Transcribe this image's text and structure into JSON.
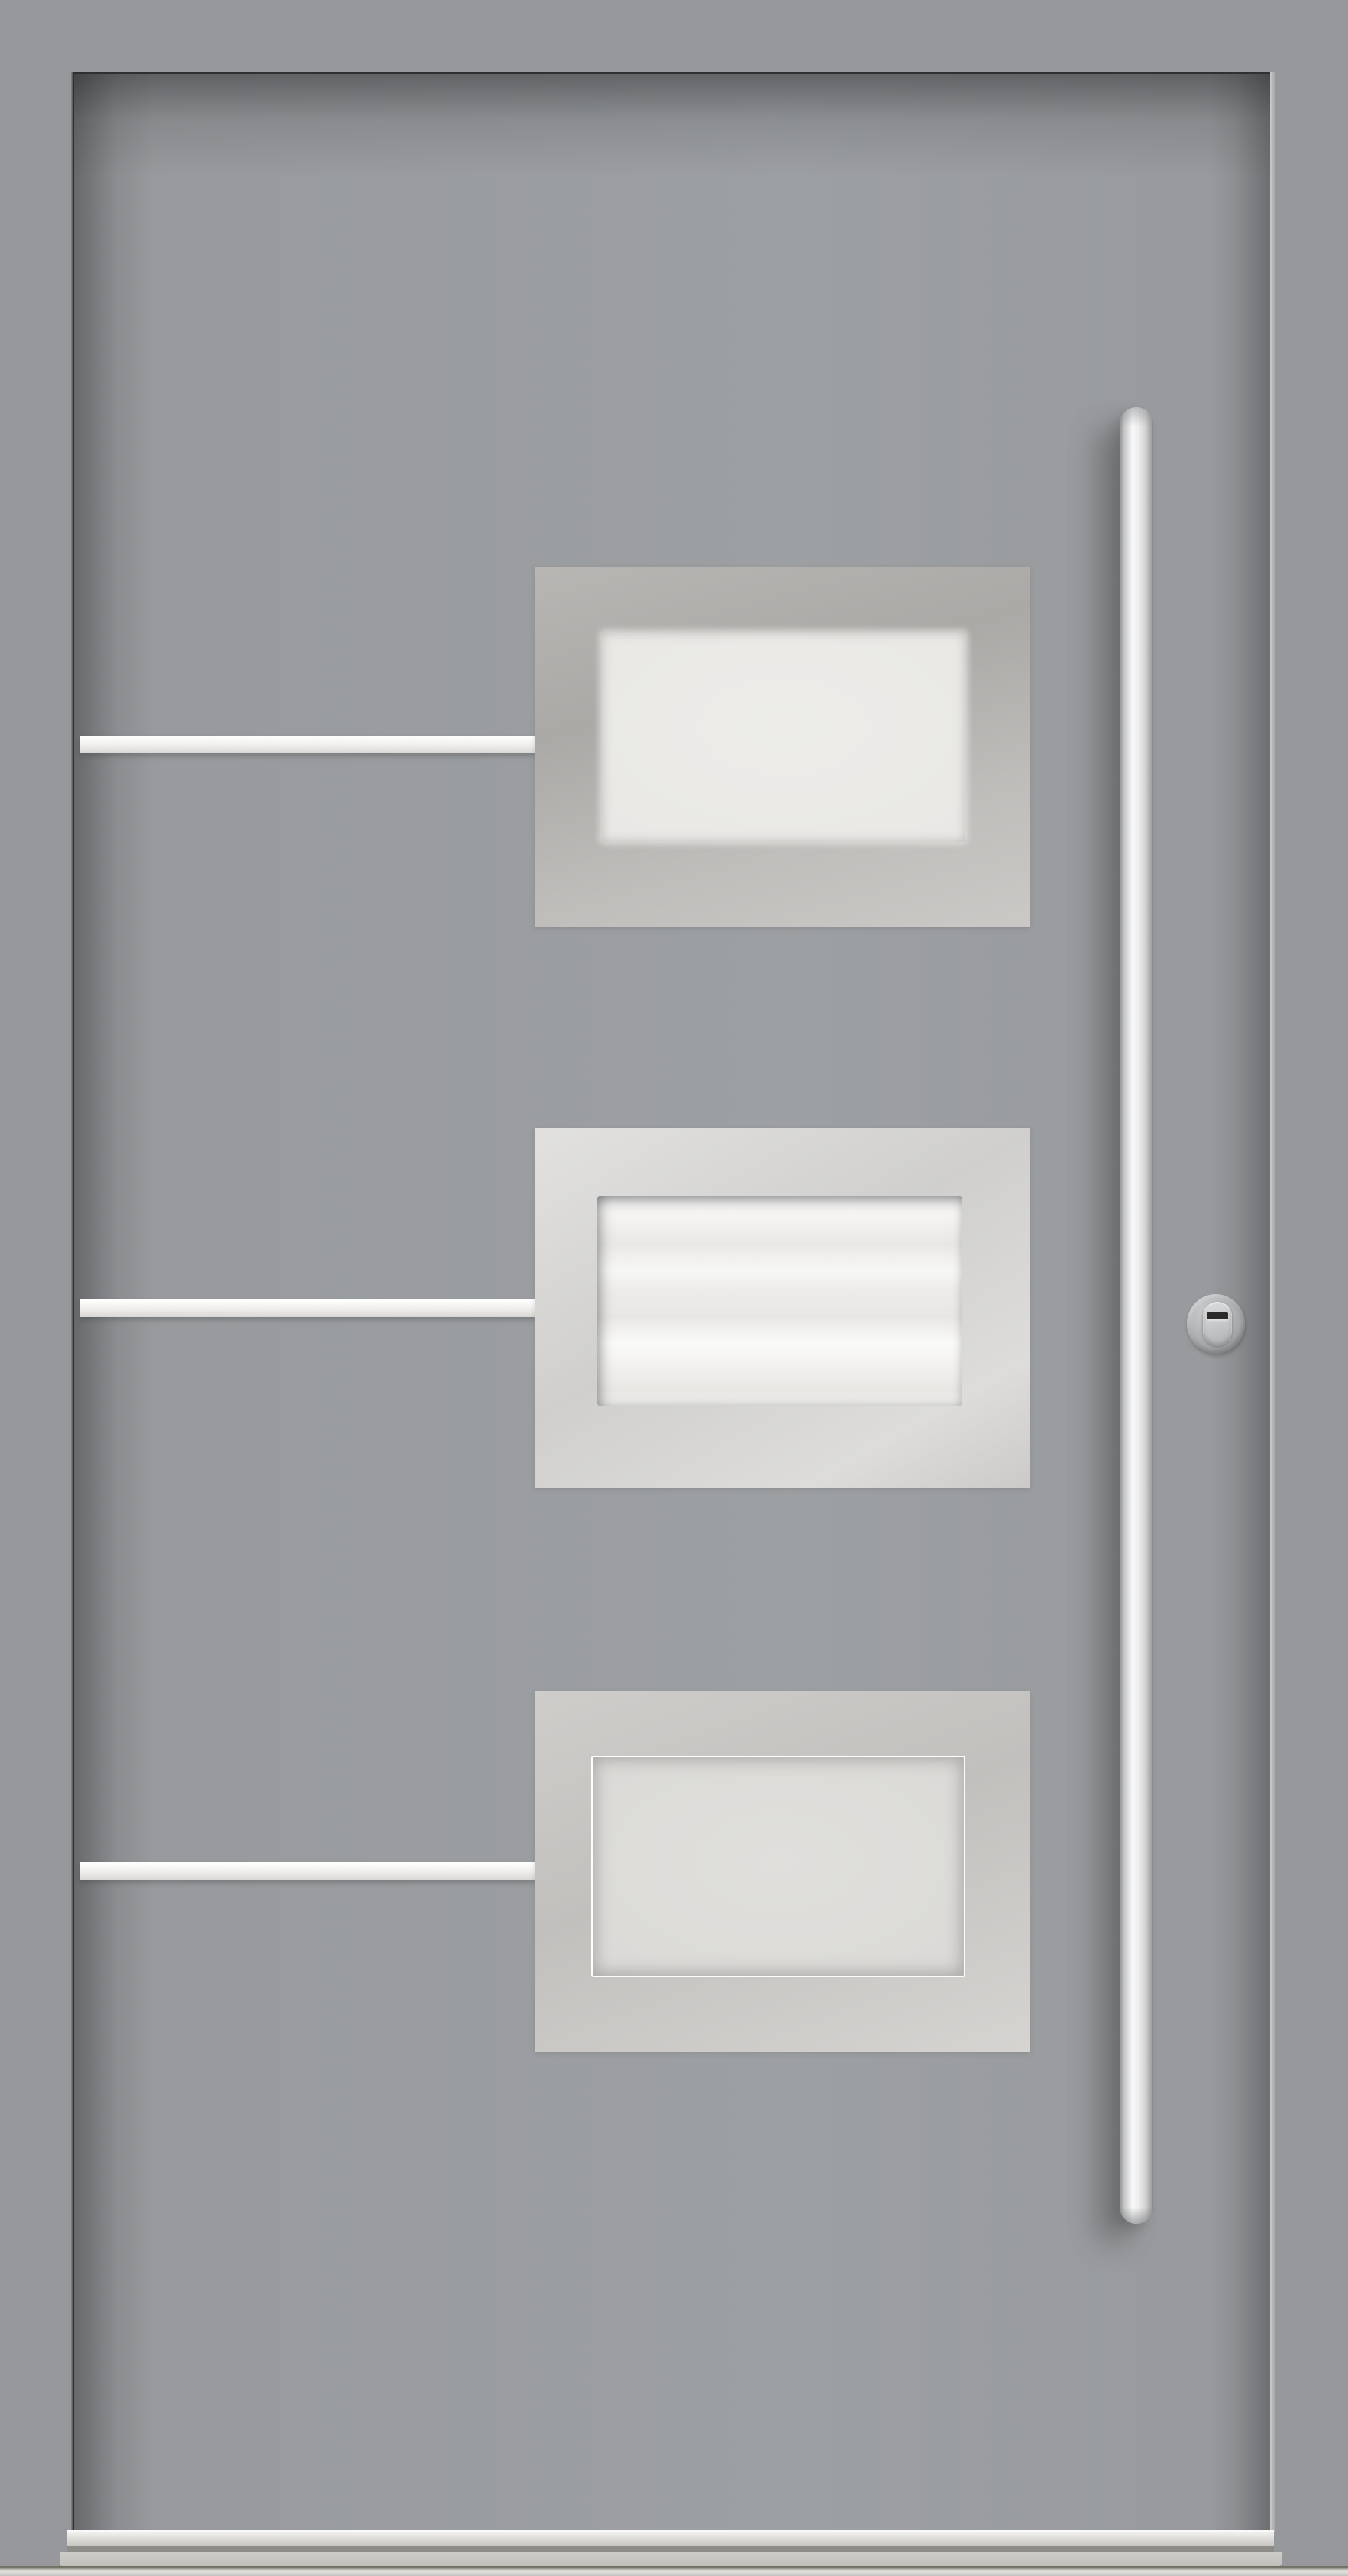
{
  "image": {
    "type": "product-photo",
    "subject": "Modern gray aluminium entrance door, front view",
    "visible_text": "",
    "features": {
      "door_leaf": "flat gray aluminium leaf with shadowed seams on top and left, highlighted seam on right",
      "glazing_panels": {
        "count": 3,
        "description": "rectangular brushed stainless-steel panels, each with an inset frosted obscure-glass window, stacked vertically on the right-center of the leaf",
        "items": [
          {
            "position": "top",
            "finish": "brushed steel, medium tone",
            "glass": "frosted, soft blurred edge"
          },
          {
            "position": "middle",
            "finish": "brushed steel, brightest",
            "glass": "near-white frosted with horizontal streaks and recessed top/left shadow"
          },
          {
            "position": "bottom",
            "finish": "brushed steel, light tone",
            "glass": "frosted with thin white outline frame"
          }
        ]
      },
      "decor_stripes": {
        "count": 3,
        "description": "thin white horizontal inlay stripes running from the left door edge to the left edge of each glazing panel, aligned with panel centers"
      },
      "pull_handle": "long vertical round stainless bar handle on the right side with rounded ends and soft drop shadow to the lower left",
      "lock_rosette": "round brushed security rosette with vertical oval cylinder guard and dark horizontal keyway slot, right of middle panel",
      "threshold": "horizontal aluminium threshold bar and sill at the door bottom with bright metal floor strip across full width"
    }
  },
  "colors": {
    "wall": "#96989B",
    "leaf": "#97999C",
    "leaf_light": "#9DA0A3",
    "seam_dark": "#2E3032",
    "seam_right_highlight": "#C9CBCD",
    "stripe_base": "#EFEEEC",
    "stripe_shade": "#D8D7D4",
    "panel1_a": "#B8B6B3",
    "panel1_b": "#ABA9A6",
    "panel1_c": "#CBC9C6",
    "panel2_a": "#E2E1DF",
    "panel2_b": "#D0CFCD",
    "panel2_c": "#DDDCDA",
    "panel3_a": "#CFCDCA",
    "panel3_b": "#C2C0BD",
    "panel3_c": "#D6D4D1",
    "glass1": "#E9E8E5",
    "glass2_a": "#F7F6F4",
    "glass2_b": "#ECEBE9",
    "glass3": "#DBDAD7",
    "handle_dark": "#8E9092",
    "handle_mid": "#C5C6C8",
    "handle_hi": "#F9F9F9",
    "handle_low": "#A6A8AA",
    "lock_hi": "#C9CBCD",
    "lock_mid": "#A9ABAD",
    "lock_dark": "#96989A",
    "oval_hi": "#DBDDDF",
    "oval_low": "#AEB0B2",
    "keyway": "#2B2B2B",
    "th_hi": "#F4F3F1",
    "th_mid": "#DEDCD9",
    "th_low": "#C8C6C2",
    "th_shadow": "#8E8C87",
    "sill_a": "#CFCDC8",
    "sill_b": "#C2C0BB",
    "band_dark": "#6E6E62",
    "band_hi": "#E3E1DD",
    "band_low": "#C4C2BE"
  }
}
